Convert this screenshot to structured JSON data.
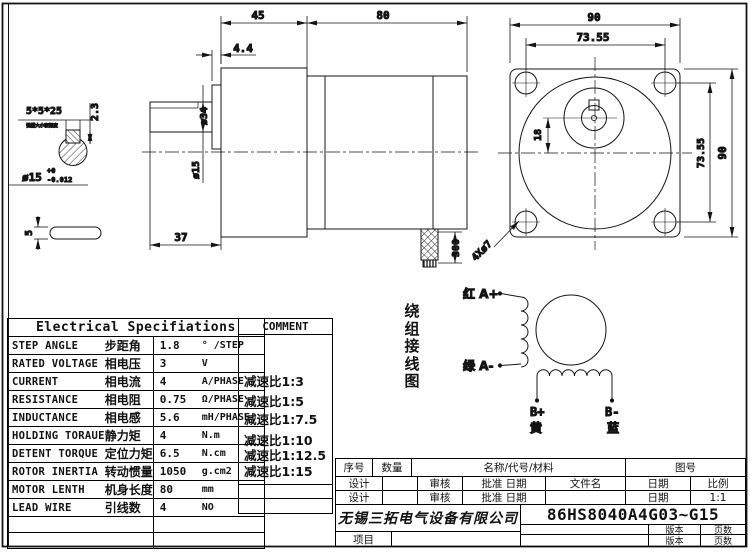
{
  "side_view": {
    "len_gearbox": "45",
    "len_motor": "80",
    "boss_thickness": "4.4",
    "boss_dia": "ø34",
    "shaft_dia": "ø15",
    "shaft_len": "37",
    "cable_len": "300"
  },
  "shaft_detail": {
    "keyway_spec": "5*5*25",
    "keyway_note": "键槽大小和深度",
    "keyway_depth": "2.3",
    "tol_base": "ø15",
    "tol_upper": "+0",
    "tol_lower": "-0.012",
    "key_height": "5"
  },
  "front_view": {
    "flange_width": "90",
    "hole_spacing_h": "73.55",
    "hole_spacing_v": "73.55",
    "flange_height": "90",
    "shaft_offset": "18",
    "holes": "4Xø7"
  },
  "spec_table": {
    "title": "Electrical Specifiations",
    "rows": [
      {
        "en": "STEP ANGLE",
        "cn": "步距角",
        "value": "1.8",
        "unit": "° /STEP"
      },
      {
        "en": "RATED VOLTAGE",
        "cn": "相电压",
        "value": "3",
        "unit": "V"
      },
      {
        "en": "CURRENT",
        "cn": "相电流",
        "value": "4",
        "unit": "A/PHASE"
      },
      {
        "en": "RESISTANCE",
        "cn": "相电阻",
        "value": "0.75",
        "unit": "Ω/PHASE"
      },
      {
        "en": "INDUCTANCE",
        "cn": "相电感",
        "value": "5.6",
        "unit": "mH/PHASE"
      },
      {
        "en": "HOLDING TORAUE",
        "cn": "静力矩",
        "value": "4",
        "unit": "N.m"
      },
      {
        "en": "DETENT TORQUE",
        "cn": "定位力矩",
        "value": "6.5",
        "unit": "N.cm"
      },
      {
        "en": "ROTOR INERTIA",
        "cn": "转动惯量",
        "value": "1050",
        "unit": "g.cm2"
      },
      {
        "en": "MOTOR LENTH",
        "cn": "机身长度",
        "value": "80",
        "unit": "mm"
      },
      {
        "en": "LEAD WIRE",
        "cn": "引线数",
        "value": "4",
        "unit": "NO"
      }
    ]
  },
  "comment": {
    "header": "COMMENT",
    "items": [
      "减速比1:3",
      "减速比1:5",
      "减速比1:7.5",
      "减速比1:10",
      "减速比1:12.5",
      "减速比1:15"
    ]
  },
  "wiring": {
    "label": "绕组接线图",
    "a_plus": "红 A+",
    "a_minus": "绿 A-",
    "b_plus": "B+",
    "b_plus_color": "黄",
    "b_minus": "B-",
    "b_minus_color": "蓝"
  },
  "title_block": {
    "seq": "序号",
    "qty": "数量",
    "name_code_material": "名称/代号/材料",
    "drawing_no": "图号",
    "design": "设计",
    "review": "审核",
    "approve_date": "批准  日期",
    "file_name": "文件名",
    "date": "日期",
    "scale": "比例",
    "scale_value": "1:1",
    "company": "无锡三拓电气设备有限公司",
    "part_number": "86HS8040A4G03~G15",
    "version": "版本",
    "pages": "页数",
    "project": "项目"
  }
}
